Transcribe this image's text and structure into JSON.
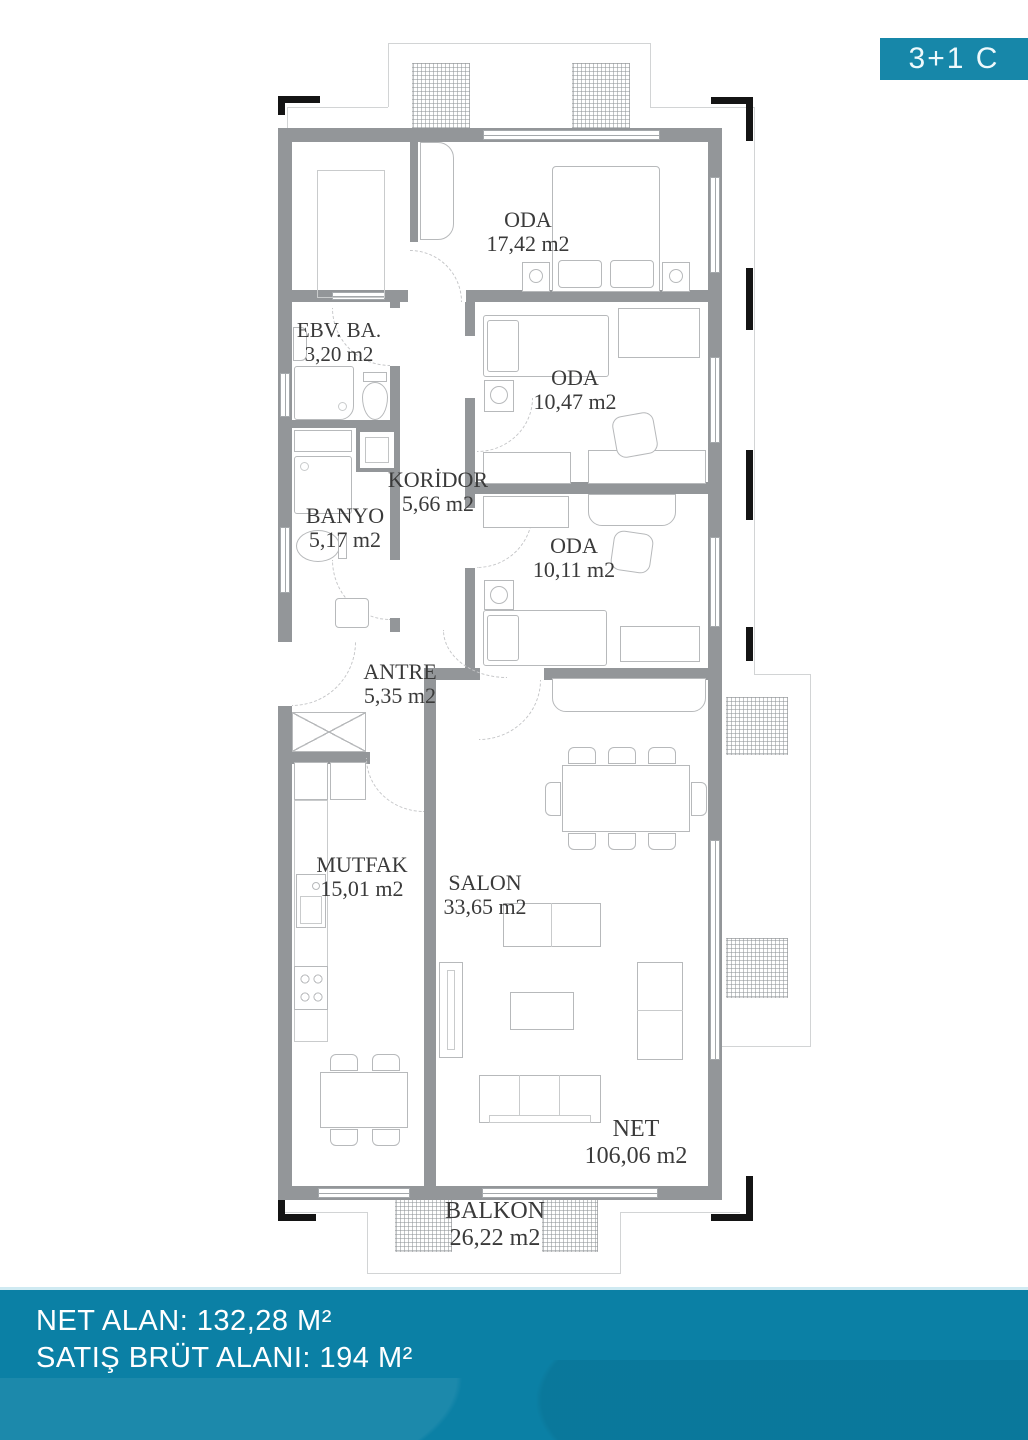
{
  "badge": {
    "label": "3+1 C"
  },
  "footer": {
    "line1": "NET ALAN: 132,28 M²",
    "line2": "SATIŞ BRÜT ALANI: 194 M²"
  },
  "rooms": [
    {
      "id": "oda-master",
      "name": "ODA",
      "area": "17,42 m2"
    },
    {
      "id": "ebv-banyo",
      "name": "EBV. BA.",
      "area": "3,20 m2"
    },
    {
      "id": "oda-2",
      "name": "ODA",
      "area": "10,47 m2"
    },
    {
      "id": "koridor",
      "name": "KORİDOR",
      "area": "5,66 m2"
    },
    {
      "id": "banyo",
      "name": "BANYO",
      "area": "5,17 m2"
    },
    {
      "id": "oda-3",
      "name": "ODA",
      "area": "10,11 m2"
    },
    {
      "id": "antre",
      "name": "ANTRE",
      "area": "5,35 m2"
    },
    {
      "id": "mutfak",
      "name": "MUTFAK",
      "area": "15,01 m2"
    },
    {
      "id": "salon",
      "name": "SALON",
      "area": "33,65 m2"
    },
    {
      "id": "net",
      "name": "NET",
      "area": "106,06 m2"
    },
    {
      "id": "balkon",
      "name": "BALKON",
      "area": "26,22 m2"
    }
  ],
  "colors": {
    "teal_footer": "#0b80a5",
    "teal_badge": "#1787a9",
    "wall_gray": "#939699",
    "furniture_gray": "#b7b9bb",
    "label_text": "#3a3a3a"
  }
}
